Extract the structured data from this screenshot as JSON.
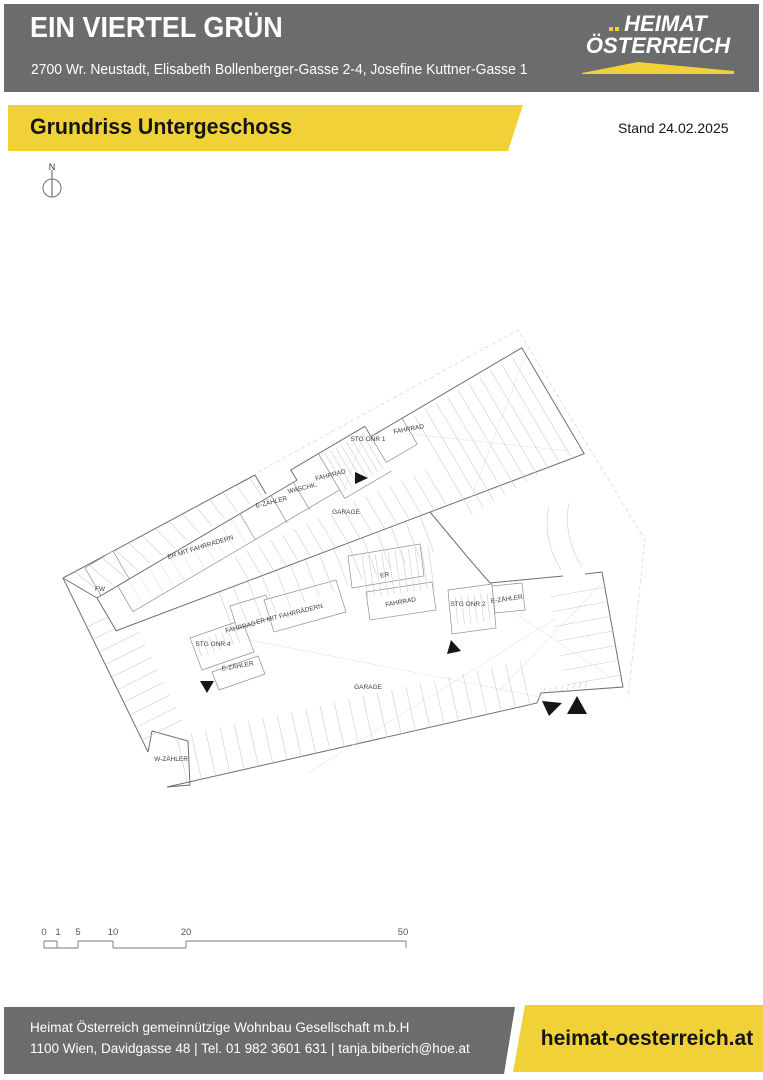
{
  "header": {
    "title": "EIN VIERTEL GRÜN",
    "address": "2700 Wr. Neustadt, Elisabeth Bollenberger-Gasse 2-4, Josefine Kuttner-Gasse 1",
    "logo": {
      "line1": "HEIMAT",
      "line2": "ÖSTERREICH"
    }
  },
  "ribbon": {
    "title": "Grundriss Untergeschoss",
    "stand": "Stand 24.02.2025"
  },
  "plan": {
    "north_label": "N",
    "labels": [
      {
        "text": "STG ONR 1",
        "x": 368,
        "y": 441,
        "r": 0
      },
      {
        "text": "FAHRRAD",
        "x": 409,
        "y": 431,
        "r": -10
      },
      {
        "text": "FAHRRAD",
        "x": 331,
        "y": 477,
        "r": -14
      },
      {
        "text": "WASCHK.",
        "x": 303,
        "y": 490,
        "r": -14
      },
      {
        "text": "E-ZÄHLER",
        "x": 272,
        "y": 504,
        "r": -14
      },
      {
        "text": "GARAGE",
        "x": 346,
        "y": 514,
        "r": 0
      },
      {
        "text": "ER MIT FAHRRÄDERN",
        "x": 201,
        "y": 549,
        "r": -17
      },
      {
        "text": "FW",
        "x": 100,
        "y": 591,
        "r": 0
      },
      {
        "text": "ER",
        "x": 385,
        "y": 577,
        "r": -10
      },
      {
        "text": "FAHRRAD",
        "x": 401,
        "y": 604,
        "r": -10
      },
      {
        "text": "STG ONR 2",
        "x": 468,
        "y": 606,
        "r": 0
      },
      {
        "text": "E-ZÄHLER",
        "x": 507,
        "y": 601,
        "r": -8
      },
      {
        "text": "ER MIT FAHRRÄDERN",
        "x": 290,
        "y": 616,
        "r": -14
      },
      {
        "text": "FAHRRAD",
        "x": 241,
        "y": 629,
        "r": -14
      },
      {
        "text": "STG ONR 4",
        "x": 213,
        "y": 646,
        "r": 0
      },
      {
        "text": "E-ZÄHLER",
        "x": 238,
        "y": 668,
        "r": -10
      },
      {
        "text": "GARAGE",
        "x": 368,
        "y": 689,
        "r": 0
      },
      {
        "text": "W-ZÄHLER",
        "x": 171,
        "y": 761,
        "r": 0
      }
    ]
  },
  "scalebar": {
    "marks": [
      {
        "label": "0",
        "x": 44
      },
      {
        "label": "1",
        "x": 58
      },
      {
        "label": "5",
        "x": 78
      },
      {
        "label": "10",
        "x": 113
      },
      {
        "label": "20",
        "x": 186
      },
      {
        "label": "50",
        "x": 403
      }
    ]
  },
  "footer": {
    "company": "Heimat Österreich gemeinnützige Wohnbau Gesellschaft m.b.H",
    "contact": "1100 Wien, Davidgasse 48 | Tel. 01 982 3601 631 | tanja.biberich@hoe.at",
    "website": "heimat-oesterreich.at"
  },
  "colors": {
    "brand_yellow": "#F0D238",
    "header_gray": "#6B6C6E"
  }
}
